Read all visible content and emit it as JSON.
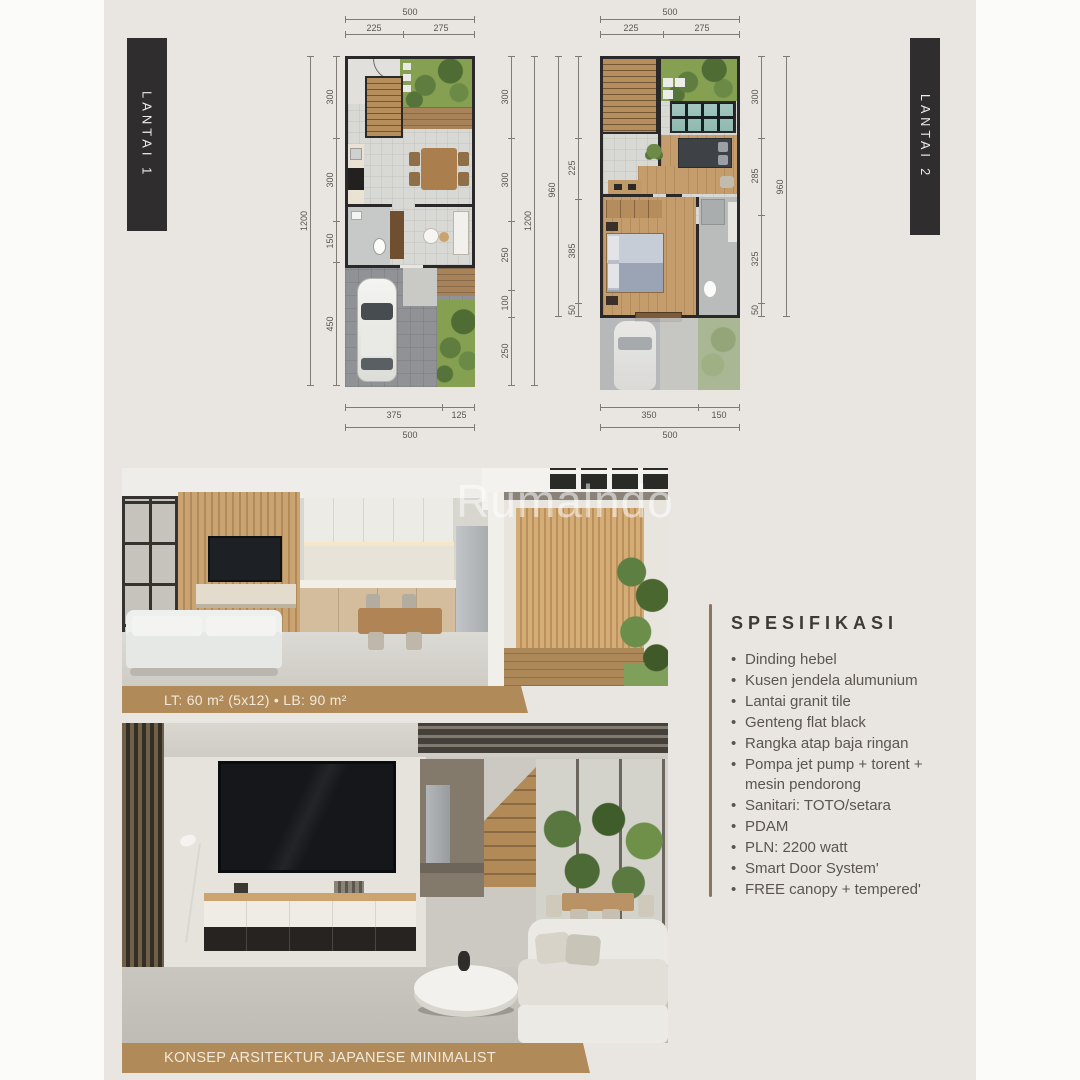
{
  "page": {
    "background": "#fbfbf9",
    "panel_color": "#e9e6e1",
    "accent_tan": "#b08a58",
    "tag_bar_color": "#302d2e"
  },
  "watermark": {
    "text": "Rumalndo"
  },
  "floors": {
    "floor1_label": "LANTAI 1",
    "floor2_label": "LANTAI 2"
  },
  "plans": {
    "plan1": {
      "top": {
        "overall": "500",
        "a": "225",
        "b": "275"
      },
      "bottom": {
        "a": "375",
        "b": "125",
        "overall": "500"
      },
      "left": {
        "overall": "1200",
        "s1": "300",
        "s2": "300",
        "s3": "150",
        "s4": "450"
      },
      "right": {
        "s1": "300",
        "s2": "300",
        "s3": "250",
        "s4": "100",
        "s5": "250",
        "overall": "1200"
      }
    },
    "plan2": {
      "top": {
        "overall": "500",
        "a": "225",
        "b": "275"
      },
      "bottom": {
        "a": "350",
        "b": "150",
        "overall": "500"
      },
      "left": {
        "overall": "960",
        "s2": "225",
        "s3": "385",
        "s4": "50"
      },
      "right": {
        "s1": "300",
        "s2": "285",
        "s3": "325",
        "s4": "50",
        "overall": "960"
      }
    }
  },
  "captions": {
    "photo1": "LT: 60 m² (5x12) • LB: 90 m²",
    "photo2": "KONSEP ARSITEKTUR JAPANESE MINIMALIST"
  },
  "spec": {
    "heading": "SPESIFIKASI",
    "items": [
      "Dinding hebel",
      "Kusen jendela alumunium",
      "Lantai granit tile",
      "Genteng flat black",
      "Rangka atap baja ringan",
      "Pompa jet pump + torent + mesin pendorong",
      "Sanitari: TOTO/setara",
      "PDAM",
      "PLN: 2200 watt",
      "Smart Door System'",
      "FREE canopy + tempered'"
    ]
  }
}
